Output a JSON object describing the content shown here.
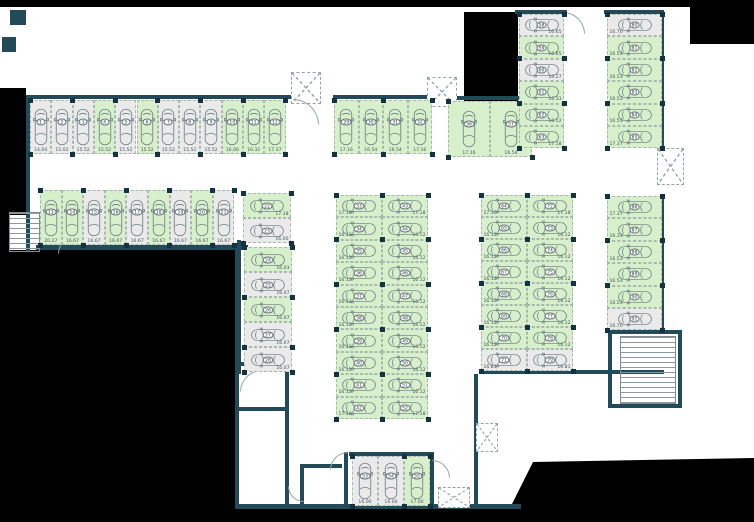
{
  "plan": {
    "type": "parking-floor-plan",
    "legend": {
      "available_state": "available",
      "occupied_state": "occupied",
      "available_color": "#d7efcb",
      "occupied_color": "#eaeaea",
      "wall_color": "#224a59",
      "background_color": "#000000"
    },
    "groups": [
      {
        "name": "row-1-12",
        "dir": "row",
        "orient": "v",
        "x": 30,
        "y": 100,
        "cw": 21.3,
        "ch": 54,
        "stalls": [
          [
            "1",
            "14.04",
            "o"
          ],
          [
            "2",
            "15.02",
            "o"
          ],
          [
            "3",
            "15.52",
            "o"
          ],
          [
            "4",
            "15.52",
            "a"
          ],
          [
            "5",
            "15.52",
            "o"
          ],
          [
            "6",
            "15.52",
            "a"
          ],
          [
            "7",
            "15.52",
            "o"
          ],
          [
            "8",
            "15.52",
            "o"
          ],
          [
            "9",
            "15.52",
            "o"
          ],
          [
            "10",
            "16.06",
            "a"
          ],
          [
            "11",
            "16.32",
            "a"
          ],
          [
            "12",
            "17.37",
            "a"
          ]
        ]
      },
      {
        "name": "row-29-32",
        "dir": "row",
        "orient": "v",
        "x": 334,
        "y": 100,
        "cw": 24.5,
        "ch": 54,
        "stalls": [
          [
            "29",
            "17.16",
            "a"
          ],
          [
            "30",
            "16.54",
            "a"
          ],
          [
            "31",
            "16.54",
            "a"
          ],
          [
            "32",
            "17.16",
            "a"
          ]
        ]
      },
      {
        "name": "row-13-21",
        "dir": "row",
        "orient": "v",
        "x": 40,
        "y": 190,
        "cw": 21.6,
        "ch": 55,
        "stalls": [
          [
            "13",
            "20.27",
            "a"
          ],
          [
            "14",
            "16.67",
            "a"
          ],
          [
            "15",
            "16.67",
            "o"
          ],
          [
            "16",
            "16.67",
            "a"
          ],
          [
            "17",
            "16.67",
            "o"
          ],
          [
            "18",
            "16.67",
            "a"
          ],
          [
            "19",
            "16.67",
            "o"
          ],
          [
            "20",
            "16.67",
            "a"
          ],
          [
            "21",
            "16.67",
            "o"
          ]
        ]
      },
      {
        "name": "col-22-23",
        "dir": "col",
        "orient": "h",
        "vside": "r",
        "x": 243,
        "y": 193,
        "cw": 48,
        "ch": 25,
        "stalls": [
          [
            "22",
            "17.18",
            "a"
          ],
          [
            "23",
            "16.00",
            "o"
          ]
        ]
      },
      {
        "name": "col-24-28",
        "dir": "col",
        "orient": "h",
        "vside": "r",
        "x": 244,
        "y": 247,
        "cw": 48,
        "ch": 25,
        "stalls": [
          [
            "24",
            "16.03",
            "a"
          ],
          [
            "25",
            "16.07",
            "o"
          ],
          [
            "26",
            "16.07",
            "a"
          ],
          [
            "27",
            "16.07",
            "o"
          ],
          [
            "28",
            "16.07",
            "o"
          ]
        ]
      },
      {
        "name": "col-33-42",
        "dir": "col",
        "orient": "h",
        "vside": "l",
        "x": 336,
        "y": 195,
        "cw": 46,
        "ch": 22.4,
        "stalls": [
          [
            "33",
            "17.18",
            "a"
          ],
          [
            "34",
            "16.12",
            "a"
          ],
          [
            "35",
            "16.12",
            "a"
          ],
          [
            "36",
            "16.12",
            "a"
          ],
          [
            "37",
            "16.12",
            "a"
          ],
          [
            "38",
            "16.12",
            "a"
          ],
          [
            "39",
            "16.12",
            "a"
          ],
          [
            "40",
            "16.12",
            "a"
          ],
          [
            "41",
            "16.12",
            "a"
          ],
          [
            "42",
            "17.18",
            "a"
          ]
        ]
      },
      {
        "name": "col-43-52",
        "dir": "col",
        "orient": "h",
        "vside": "r",
        "x": 382,
        "y": 195,
        "cw": 46,
        "ch": 22.4,
        "stalls": [
          [
            "43",
            "17.18",
            "a"
          ],
          [
            "44",
            "16.12",
            "a"
          ],
          [
            "45",
            "16.12",
            "a"
          ],
          [
            "46",
            "16.12",
            "a"
          ],
          [
            "47",
            "16.12",
            "a"
          ],
          [
            "48",
            "16.12",
            "a"
          ],
          [
            "49",
            "16.12",
            "a"
          ],
          [
            "50",
            "16.12",
            "a"
          ],
          [
            "51",
            "16.12",
            "a"
          ],
          [
            "52",
            "17.18",
            "a"
          ]
        ]
      },
      {
        "name": "col-64-71",
        "dir": "col",
        "orient": "h",
        "vside": "l",
        "x": 481,
        "y": 195,
        "cw": 46,
        "ch": 22,
        "stalls": [
          [
            "64",
            "17.30",
            "a"
          ],
          [
            "65",
            "16.12",
            "a"
          ],
          [
            "66",
            "16.12",
            "a"
          ],
          [
            "67",
            "16.12",
            "a"
          ],
          [
            "68",
            "16.12",
            "a"
          ],
          [
            "69",
            "16.12",
            "a"
          ],
          [
            "70",
            "16.12",
            "a"
          ],
          [
            "71",
            "16.81",
            "o"
          ]
        ]
      },
      {
        "name": "col-72-79",
        "dir": "col",
        "orient": "h",
        "vside": "r",
        "x": 527,
        "y": 195,
        "cw": 46,
        "ch": 22,
        "stalls": [
          [
            "72",
            "17.18",
            "a"
          ],
          [
            "73",
            "16.12",
            "a"
          ],
          [
            "74",
            "16.12",
            "a"
          ],
          [
            "75",
            "16.12",
            "a"
          ],
          [
            "76",
            "16.12",
            "a"
          ],
          [
            "77",
            "16.12",
            "a"
          ],
          [
            "78",
            "16.12",
            "a"
          ],
          [
            "79",
            "16.81",
            "o"
          ]
        ]
      },
      {
        "name": "pair-56-57",
        "dir": "row",
        "orient": "v",
        "x": 448,
        "y": 101,
        "cw": 42,
        "ch": 56,
        "stalls": [
          [
            "56",
            "17.16",
            "a"
          ],
          [
            "57",
            "16.54",
            "a"
          ]
        ]
      },
      {
        "name": "col-58-63",
        "dir": "col",
        "orient": "h",
        "vside": "r",
        "x": 519,
        "y": 14,
        "cw": 45,
        "ch": 22.4,
        "stalls": [
          [
            "58",
            "16.65",
            "o"
          ],
          [
            "59",
            "16.65",
            "a"
          ],
          [
            "60",
            "16.27",
            "o"
          ],
          [
            "61",
            "16.33",
            "a"
          ],
          [
            "62",
            "16.12",
            "a"
          ],
          [
            "63",
            "17.18",
            "a"
          ]
        ]
      },
      {
        "name": "col-80-85",
        "dir": "col",
        "orient": "h",
        "vside": "l",
        "x": 607,
        "y": 14,
        "cw": 55,
        "ch": 22.4,
        "stalls": [
          [
            "80",
            "16.70",
            "o"
          ],
          [
            "81",
            "16.53",
            "a"
          ],
          [
            "82",
            "16.53",
            "a"
          ],
          [
            "83",
            "16.53",
            "a"
          ],
          [
            "84",
            "16.53",
            "a"
          ],
          [
            "85",
            "17.37",
            "a"
          ]
        ]
      },
      {
        "name": "col-86-91",
        "dir": "col",
        "orient": "h",
        "vside": "l",
        "x": 607,
        "y": 196,
        "cw": 55,
        "ch": 22.4,
        "stalls": [
          [
            "86",
            "17.37",
            "a"
          ],
          [
            "87",
            "16.33",
            "a"
          ],
          [
            "88",
            "16.53",
            "a"
          ],
          [
            "89",
            "16.53",
            "a"
          ],
          [
            "90",
            "16.53",
            "a"
          ],
          [
            "91",
            "16.70",
            "o"
          ]
        ]
      },
      {
        "name": "row-53-55",
        "dir": "row",
        "orient": "v",
        "x": 352,
        "y": 456,
        "cw": 26,
        "ch": 50,
        "stalls": [
          [
            "53",
            "16.00",
            "o"
          ],
          [
            "54",
            "16.00",
            "o"
          ],
          [
            "55",
            "17.00",
            "a"
          ]
        ]
      }
    ],
    "exterior": [
      [
        0,
        0,
        754,
        7,
        ""
      ],
      [
        0,
        88,
        26,
        127,
        ""
      ],
      [
        0,
        215,
        9,
        37,
        ""
      ],
      [
        0,
        250,
        236,
        272,
        ""
      ],
      [
        236,
        508,
        518,
        14,
        ""
      ],
      [
        690,
        0,
        64,
        44,
        ""
      ],
      [
        464,
        12,
        54,
        92,
        ""
      ],
      [
        500,
        458,
        254,
        64,
        "polygon(33px 4px,254px 0px,254px 64px,3px 64px)"
      ]
    ],
    "walls": [
      [
        28,
        95,
        266,
        4
      ],
      [
        26,
        95,
        4,
        157
      ],
      [
        333,
        95,
        101,
        4
      ],
      [
        36,
        245,
        212,
        5
      ],
      [
        237,
        240,
        4,
        134
      ],
      [
        445,
        96,
        92,
        4
      ],
      [
        515,
        10,
        52,
        4
      ],
      [
        604,
        10,
        60,
        4
      ],
      [
        660,
        14,
        4,
        136
      ],
      [
        660,
        196,
        4,
        136
      ],
      [
        479,
        370,
        185,
        4
      ],
      [
        474,
        374,
        4,
        134
      ],
      [
        235,
        250,
        4,
        258
      ],
      [
        235,
        504,
        286,
        5
      ],
      [
        237,
        362,
        52,
        4
      ],
      [
        237,
        407,
        52,
        4
      ],
      [
        285,
        362,
        4,
        146
      ],
      [
        300,
        464,
        4,
        44
      ],
      [
        300,
        464,
        42,
        4
      ],
      [
        344,
        452,
        4,
        56
      ],
      [
        430,
        452,
        4,
        56
      ],
      [
        349,
        452,
        84,
        4
      ],
      [
        608,
        330,
        74,
        4
      ],
      [
        608,
        330,
        4,
        78
      ],
      [
        608,
        404,
        74,
        4
      ],
      [
        678,
        330,
        4,
        78
      ],
      [
        10,
        10,
        16,
        15
      ],
      [
        2,
        37,
        14,
        15
      ]
    ],
    "shafts": [
      [
        291,
        72,
        30,
        32
      ],
      [
        427,
        77,
        30,
        30
      ],
      [
        657,
        148,
        27,
        37
      ],
      [
        476,
        423,
        22,
        29
      ],
      [
        438,
        487,
        32,
        21
      ]
    ],
    "stairs": [
      [
        9,
        212,
        31,
        40,
        "h"
      ],
      [
        88,
        214,
        21,
        28,
        "grid"
      ],
      [
        620,
        336,
        56,
        68,
        "h"
      ]
    ],
    "arcs": [
      [
        293,
        99,
        26,
        90
      ],
      [
        563,
        12,
        22,
        90
      ],
      [
        58,
        234,
        20,
        0
      ],
      [
        240,
        370,
        22,
        0
      ],
      [
        330,
        452,
        18,
        0
      ],
      [
        432,
        460,
        18,
        90
      ],
      [
        264,
        346,
        16,
        180
      ],
      [
        288,
        486,
        16,
        270
      ]
    ]
  }
}
